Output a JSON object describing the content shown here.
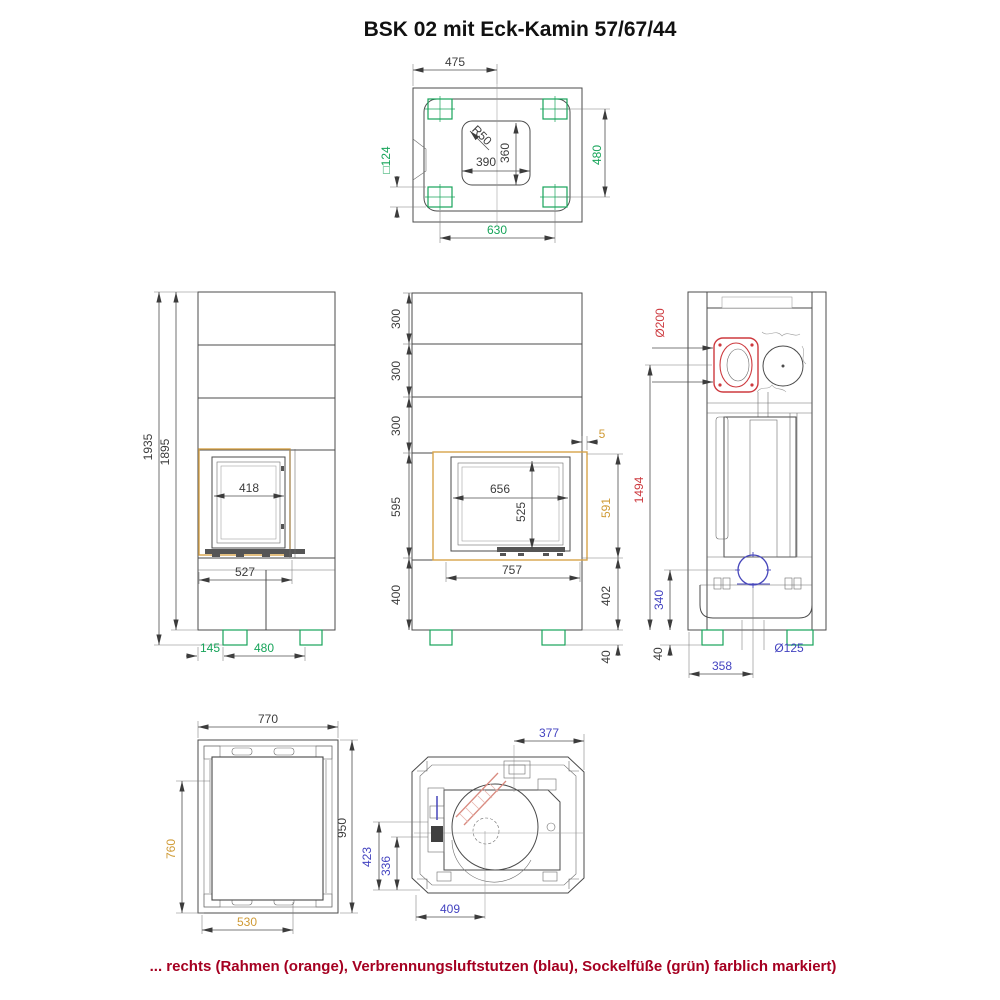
{
  "title": "BSK 02 mit Eck-Kamin 57/67/44",
  "caption": "... rechts (Rahmen (orange), Verbrennungsluftstutzen (blau), Sockelfüße (grün) farblich markiert)",
  "colors": {
    "line": "#4b4b4b",
    "frame_orange": "#d7a44a",
    "air_stub_blue": "#4646bb",
    "feet_green": "#17a45a",
    "flue_red": "#cd3a3f",
    "caption_red": "#a50021"
  },
  "views": {
    "top": {
      "width": "475",
      "foot_size": "□124",
      "feet_depth": "480",
      "feet_span": "630",
      "corner_radius": "R50",
      "opening_width": "390",
      "opening_depth": "360"
    },
    "front_left": {
      "total_height": "1935",
      "body_height": "1895",
      "door_width": "418",
      "niche_width": "527",
      "foot_offset": "145",
      "feet_span": "480"
    },
    "front_main": {
      "segment_1": "300",
      "segment_2": "300",
      "segment_3": "300",
      "niche_height": "595",
      "plinth_height": "400",
      "frame_offset": "5",
      "door_width": "656",
      "door_height": "525",
      "frame_height": "591",
      "niche_width": "757",
      "plinth_height_right": "402",
      "foot_height": "40"
    },
    "side": {
      "flue_diameter": "Ø200",
      "flue_center_height": "1494",
      "stub_center_height": "340",
      "foot_height": "40",
      "stub_offset": "358",
      "stub_diameter": "Ø125"
    },
    "bottom_left": {
      "width": "770",
      "depth": "950",
      "panel_depth": "760",
      "panel_width": "530"
    },
    "bottom_main": {
      "flue_offset": "377",
      "stub_depth_a": "423",
      "stub_depth_b": "336",
      "fan_offset": "409"
    }
  }
}
